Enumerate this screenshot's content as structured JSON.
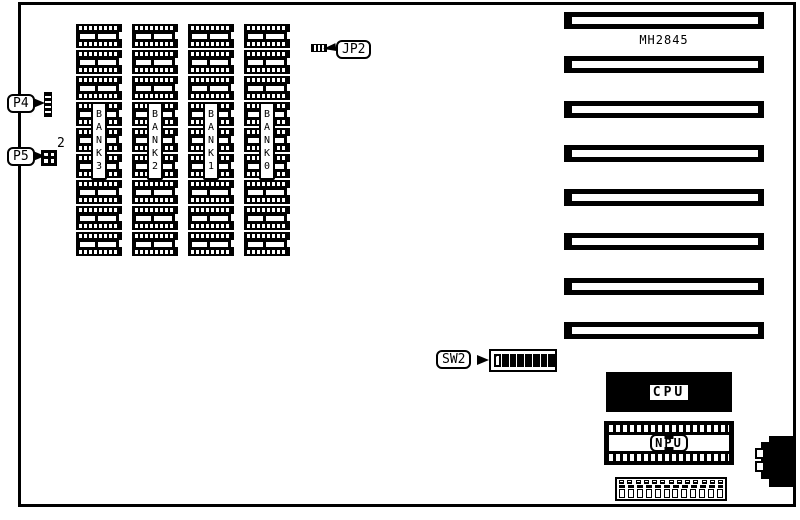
{
  "diagram": {
    "model": "MH2845",
    "memory": {
      "banks": [
        {
          "label": "BANK3",
          "chips": 9
        },
        {
          "label": "BANK2",
          "chips": 9
        },
        {
          "label": "BANK1",
          "chips": 9
        },
        {
          "label": "BANK0",
          "chips": 9
        }
      ]
    },
    "connectors": {
      "p4": {
        "label": "P4"
      },
      "p5": {
        "label": "P5",
        "superscript": "2"
      },
      "jp2": {
        "label": "JP2"
      },
      "sw2": {
        "label": "SW2",
        "switch_count": 8,
        "open_switches": 1
      }
    },
    "chips": {
      "cpu": {
        "label": "CPU"
      },
      "npu": {
        "label": "NPU"
      }
    },
    "expansion_slots": {
      "count": 8
    },
    "bottom_connector": {
      "top_pins": 13,
      "bottom_pins": 12
    }
  },
  "colors": {
    "ink": "#000000",
    "background": "#ffffff"
  }
}
